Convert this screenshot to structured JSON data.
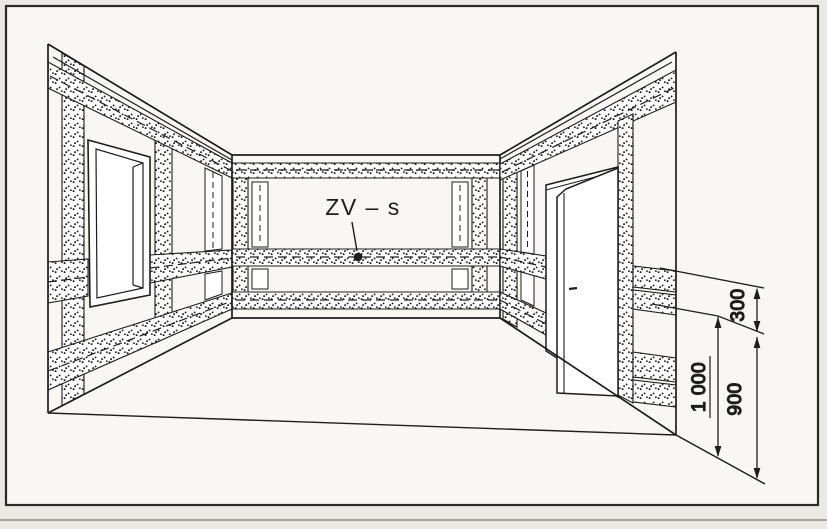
{
  "figure": {
    "labels": {
      "zone": "ZV – s"
    },
    "dimensions": {
      "zone_width": "300",
      "axis_height": "1 000",
      "bottom_height": "900"
    },
    "colors": {
      "line": "#1d1d1d",
      "paper": "#f8f7f3",
      "page_background": "#ebe9e4",
      "frame_border": "#2a2a28"
    }
  }
}
